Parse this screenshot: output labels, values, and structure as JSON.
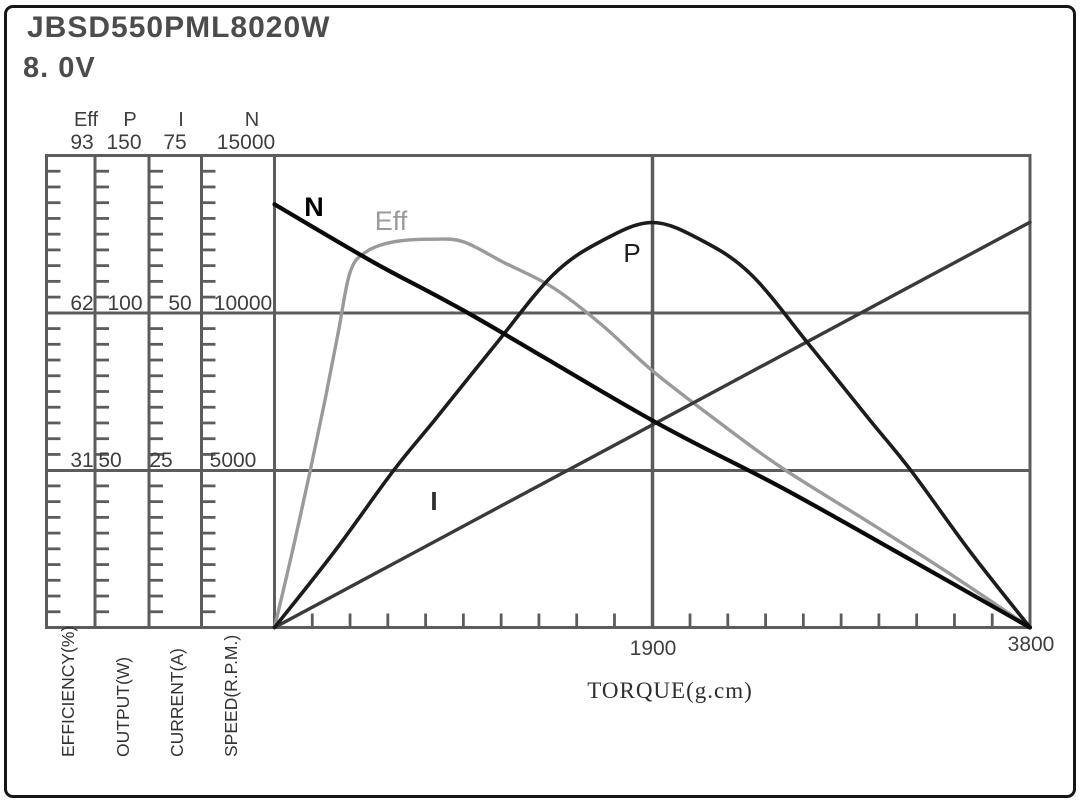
{
  "header": {
    "model": "JBSD550PML8020W",
    "voltage": "8. 0V"
  },
  "chart_data": {
    "type": "line",
    "title": "JBSD550PML8020W motor performance curves at 8. 0V",
    "xlabel": "TORQUE(g.cm)",
    "x_range": [
      0,
      3800
    ],
    "x_ticks": [
      1900,
      3800
    ],
    "x_minor_tick_step": 190,
    "grid": true,
    "frame_color": "#5c5c5c",
    "axes": [
      {
        "id": "eff",
        "label": "Eff",
        "unit_label": "EFFICIENCY(%)",
        "max": 93,
        "ticks": [
          31,
          62,
          93
        ]
      },
      {
        "id": "p",
        "label": "P",
        "unit_label": "OUTPUT(W)",
        "max": 150,
        "ticks": [
          50,
          100,
          150
        ]
      },
      {
        "id": "i",
        "label": "I",
        "unit_label": "CURRENT(A)",
        "max": 75,
        "ticks": [
          25,
          50,
          75
        ]
      },
      {
        "id": "n",
        "label": "N",
        "unit_label": "SPEED(R.P.M.)",
        "max": 15000,
        "ticks": [
          5000,
          10000,
          15000
        ]
      }
    ],
    "series": [
      {
        "name": "N",
        "axis": "n",
        "color": "#0a0a0a",
        "width": 4.2,
        "z": 4,
        "points": [
          [
            0,
            13450
          ],
          [
            500,
            11600
          ],
          [
            1000,
            9900
          ],
          [
            1900,
            6580
          ],
          [
            2550,
            4450
          ],
          [
            3200,
            2150
          ],
          [
            3800,
            0
          ]
        ]
      },
      {
        "name": "Eff",
        "axis": "eff",
        "color": "#9a9a9a",
        "width": 3.4,
        "z": 1,
        "points": [
          [
            0,
            0
          ],
          [
            90,
            15
          ],
          [
            180,
            31
          ],
          [
            255,
            45
          ],
          [
            320,
            58
          ],
          [
            380,
            70
          ],
          [
            460,
            74
          ],
          [
            600,
            76
          ],
          [
            800,
            76.5
          ],
          [
            950,
            76
          ],
          [
            1150,
            72
          ],
          [
            1400,
            67
          ],
          [
            1650,
            59.5
          ],
          [
            1900,
            50.6
          ],
          [
            2200,
            41.5
          ],
          [
            2550,
            31.5
          ],
          [
            3000,
            20.5
          ],
          [
            3400,
            10.5
          ],
          [
            3800,
            0
          ]
        ]
      },
      {
        "name": "P",
        "axis": "p",
        "color": "#1c1c1c",
        "width": 3.6,
        "z": 3,
        "points": [
          [
            0,
            0
          ],
          [
            300,
            24
          ],
          [
            600,
            50
          ],
          [
            800,
            65.5
          ],
          [
            1100,
            89
          ],
          [
            1400,
            112
          ],
          [
            1650,
            123
          ],
          [
            1900,
            128.7
          ],
          [
            2150,
            123
          ],
          [
            2400,
            112
          ],
          [
            2700,
            89
          ],
          [
            3000,
            65.5
          ],
          [
            3200,
            50
          ],
          [
            3500,
            24
          ],
          [
            3800,
            0
          ]
        ]
      },
      {
        "name": "I",
        "axis": "i",
        "color": "#3a3a3a",
        "width": 3.4,
        "z": 2,
        "points": [
          [
            0,
            0
          ],
          [
            1900,
            32.2
          ],
          [
            3800,
            64.4
          ]
        ]
      }
    ]
  }
}
